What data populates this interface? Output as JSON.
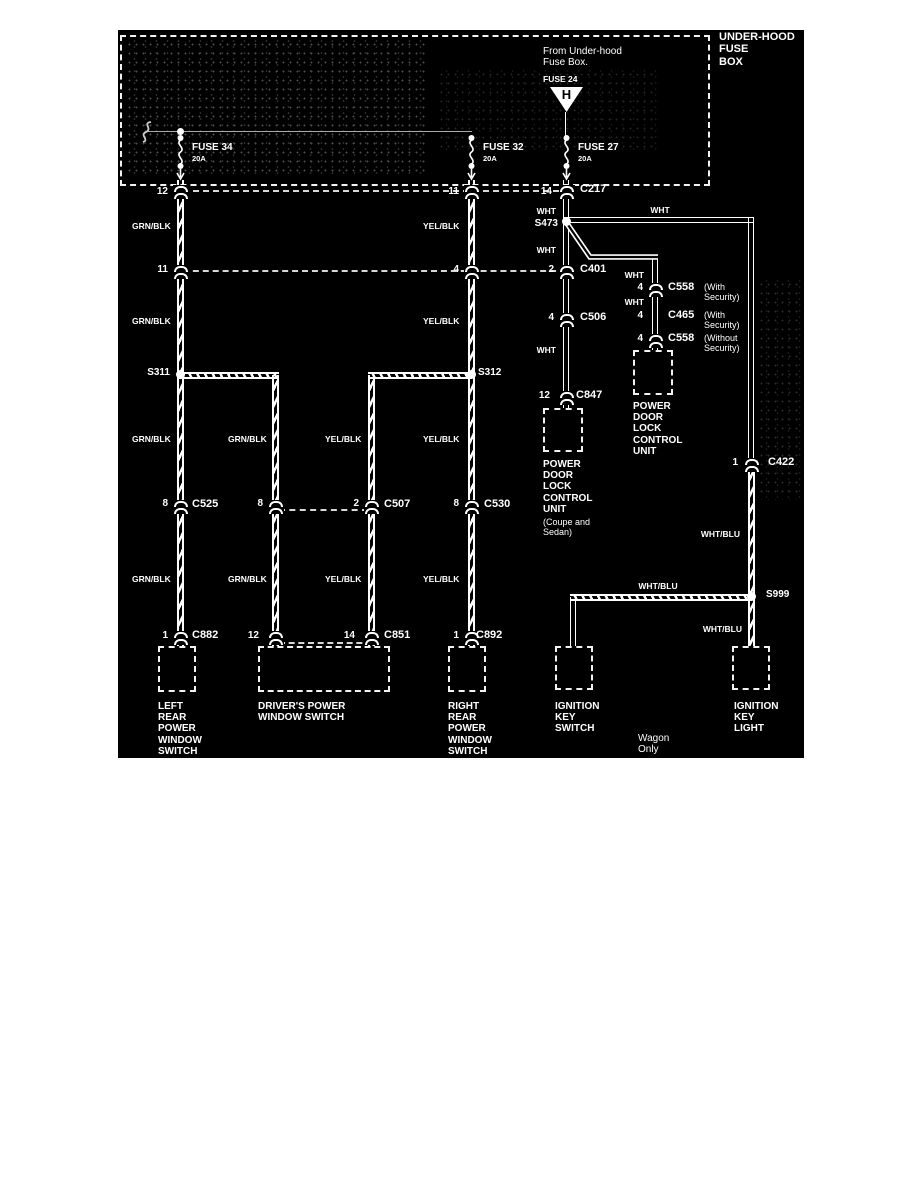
{
  "colors": {
    "page_bg": "#ffffff",
    "diagram_bg": "#000000",
    "line": "#ffffff",
    "dim_line": "#aaaaaa"
  },
  "fuse_box": {
    "title": "UNDER-HOOD\nFUSE\nBOX",
    "source_note": "From Under-hood\nFuse Box.",
    "source_fuse": "FUSE 24",
    "connector_letter": "H",
    "fuses": [
      {
        "name": "FUSE 34",
        "rating": "20A"
      },
      {
        "name": "FUSE 32",
        "rating": "20A"
      },
      {
        "name": "FUSE 27",
        "rating": "20A"
      }
    ]
  },
  "wire_colors": {
    "grn_blk": "GRN/BLK",
    "yel_blk": "YEL/BLK",
    "wht": "WHT",
    "wht_blu": "WHT/BLU"
  },
  "splices": {
    "s311": "S311",
    "s312": "S312",
    "s473": "S473",
    "s999": "S999"
  },
  "pins": {
    "p1": "1",
    "p2": "2",
    "p4": "4",
    "p8": "8",
    "p11": "11",
    "p12": "12",
    "p14": "14"
  },
  "connectors": {
    "c217": "C217",
    "c401": "C401",
    "c506": "C506",
    "c558": "C558",
    "c465": "C465",
    "c847": "C847",
    "c422": "C422",
    "c525": "C525",
    "c507": "C507",
    "c530": "C530",
    "c882": "C882",
    "c851": "C851",
    "c892": "C892"
  },
  "notes": {
    "with_security": "(With\nSecurity)",
    "without_security": "(Without\nSecurity)",
    "coupe_sedan": "(Coupe and\nSedan)",
    "wagon_only": "Wagon\nOnly"
  },
  "components": {
    "pdl_unit": "POWER\nDOOR\nLOCK\nCONTROL\nUNIT",
    "left_rear_switch": "LEFT\nREAR\nPOWER\nWINDOW\nSWITCH",
    "drivers_switch": "DRIVER'S POWER\nWINDOW SWITCH",
    "right_rear_switch": "RIGHT\nREAR\nPOWER\nWINDOW\nSWITCH",
    "ignition_key_switch": "IGNITION\nKEY\nSWITCH",
    "ignition_key_light": "IGNITION\nKEY\nLIGHT"
  }
}
